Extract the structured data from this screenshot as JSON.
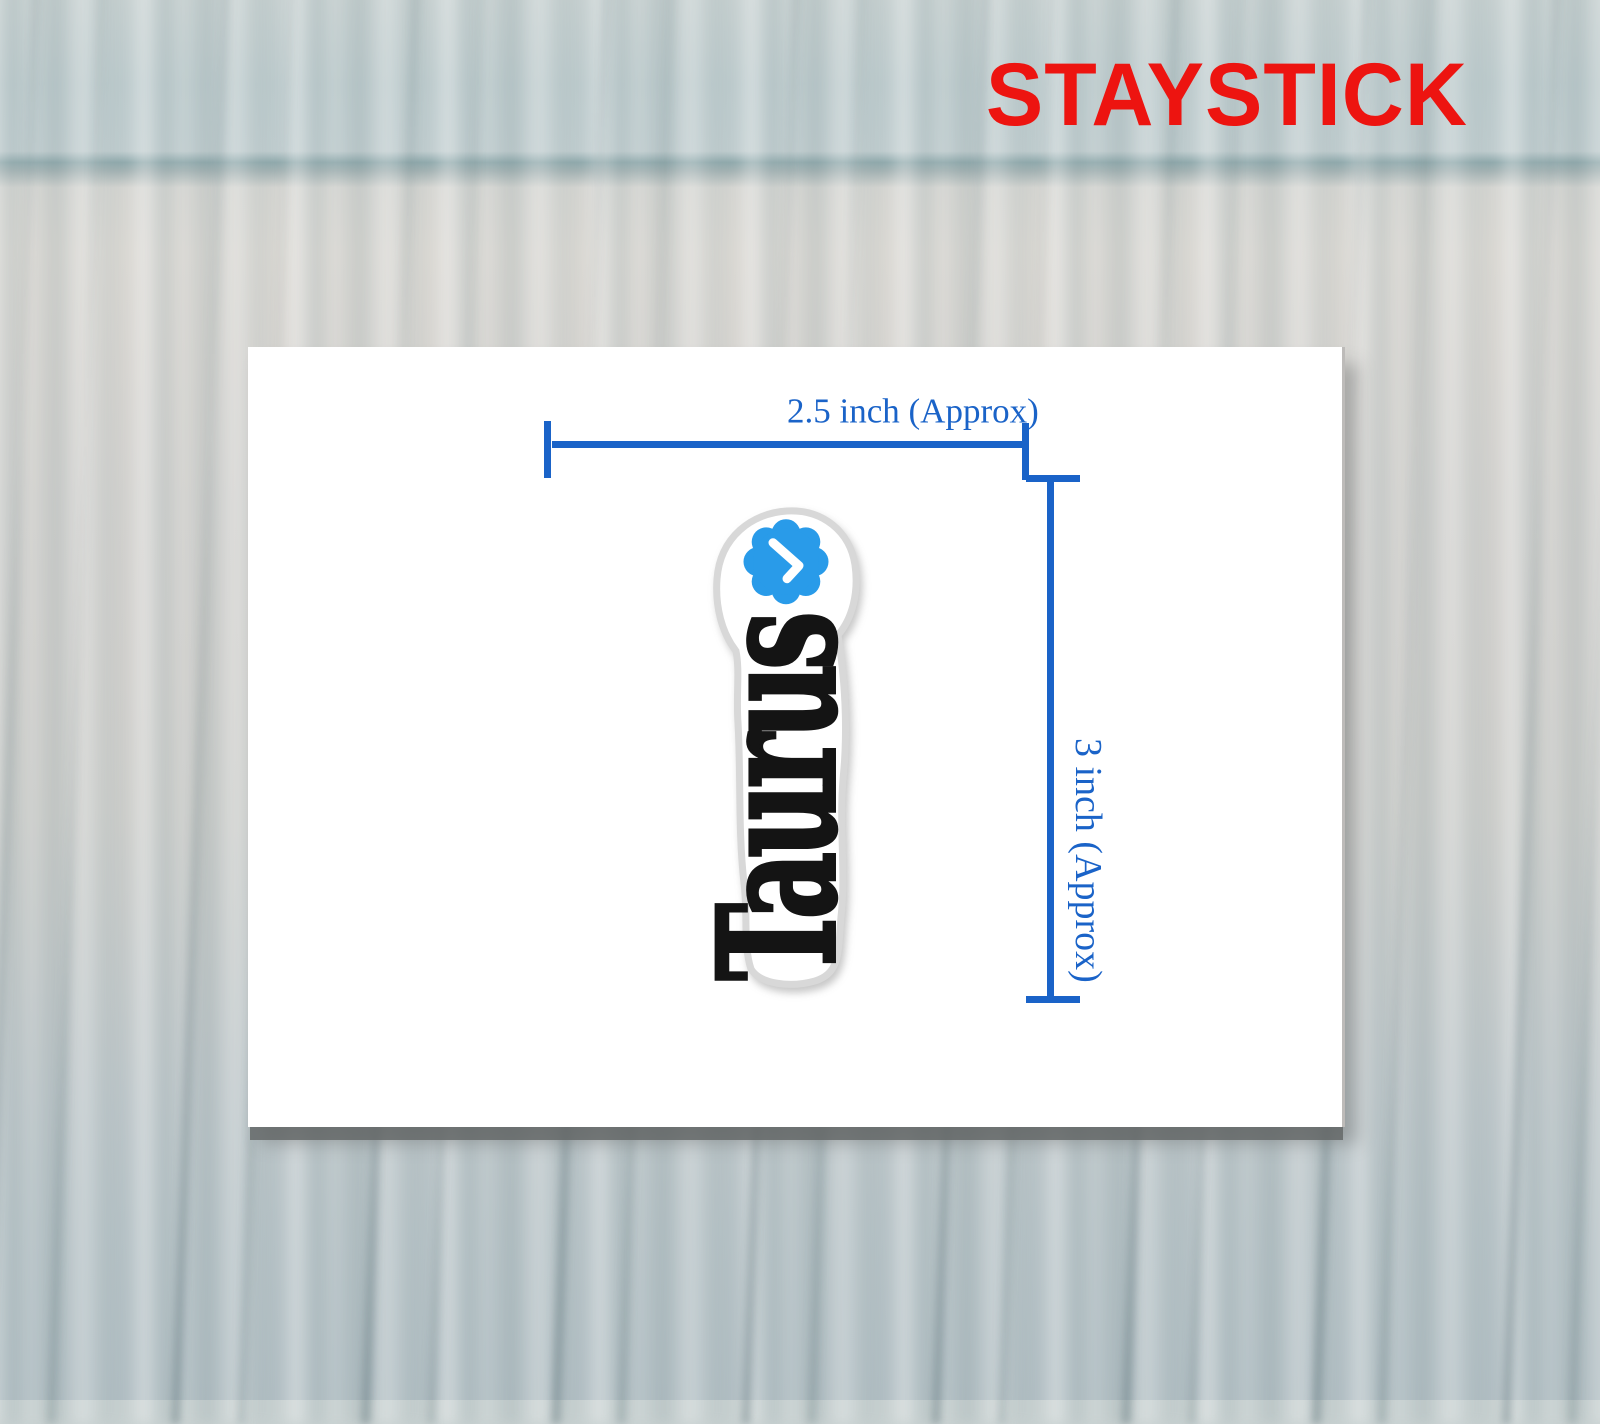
{
  "brand": {
    "name": "STAYSTICK",
    "color": "#ED1410"
  },
  "card": {
    "background": "#ffffff",
    "measurements": {
      "width_label": "2.5 inch (Approx)",
      "height_label": "3 inch (Approx)",
      "color": "#1A63C8"
    },
    "sticker": {
      "text": "Taurus",
      "text_color": "#141414",
      "outline_color": "#d8d8d8",
      "background": "#ffffff",
      "badge": {
        "icon": "verified-check-badge",
        "fill": "#299BE9",
        "check_color": "#ffffff"
      }
    }
  }
}
